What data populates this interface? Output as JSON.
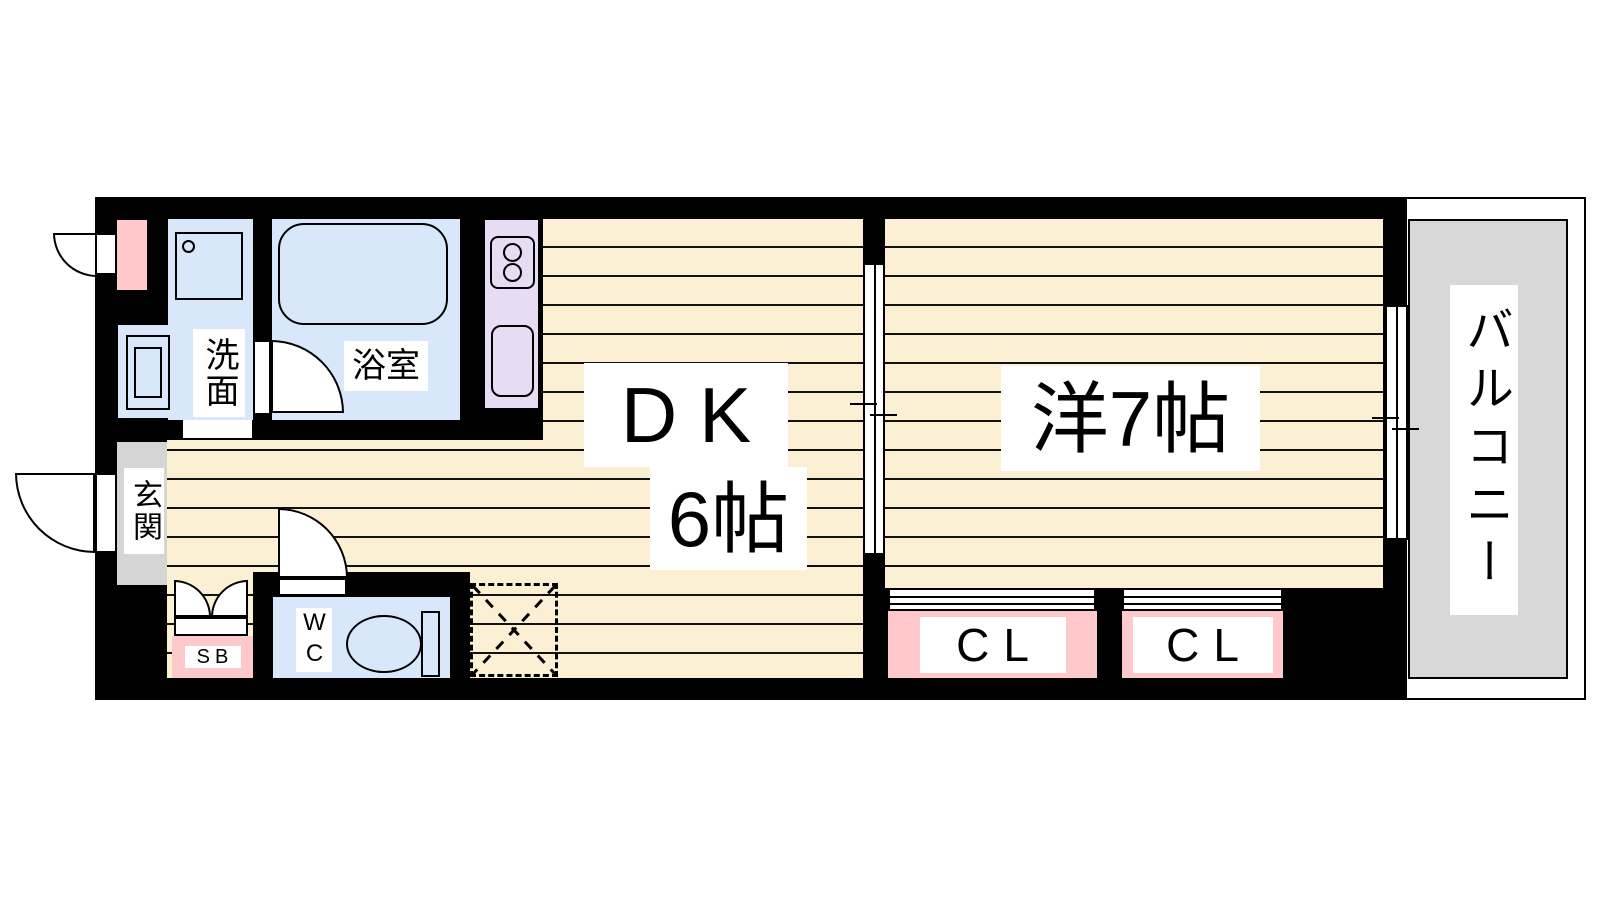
{
  "rooms": {
    "dk": {
      "label": "DK",
      "size": "6帖"
    },
    "western": {
      "label": "洋7帖"
    },
    "balcony": {
      "label": "バルコニー"
    },
    "entrance": {
      "label": "玄関"
    },
    "washroom": {
      "label": "洗面"
    },
    "bathroom": {
      "label": "浴室"
    },
    "wc": {
      "label": "WC"
    },
    "shoe_box": {
      "label": "SB"
    },
    "closet_left": {
      "label": "CL"
    },
    "closet_right": {
      "label": "CL"
    }
  },
  "colors": {
    "wall": "#000000",
    "floor_wood": "#FBF0D3",
    "wet_room_blue": "#D9E7FB",
    "kitchen_purple": "#E8DCF4",
    "accent_pink": "#FFC9CC",
    "entrance_gray": "#D5D5D5",
    "balcony_gray": "#D8D8D8"
  }
}
